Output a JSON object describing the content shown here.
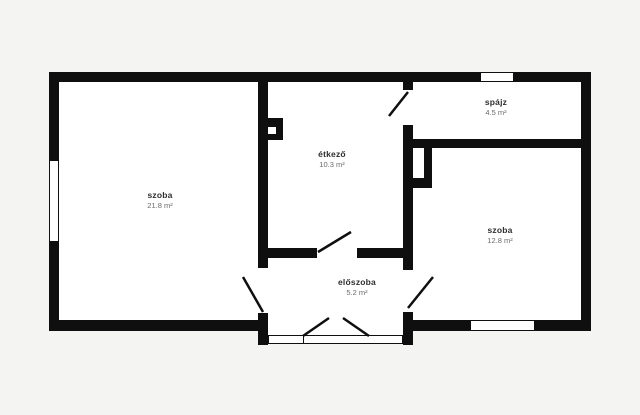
{
  "floor_plan": {
    "colors": {
      "background": "#f4f4f2",
      "wall": "#0f0f0f",
      "room_fill": "#ffffff",
      "label_text": "#2e2e2e",
      "area_text": "#6a6a6a"
    },
    "rooms": [
      {
        "name": "szoba",
        "area": "21.8 m²"
      },
      {
        "name": "étkező",
        "area": "10.3 m²"
      },
      {
        "name": "spájz",
        "area": "4.5 m²"
      },
      {
        "name": "szoba",
        "area": "12.8 m²"
      },
      {
        "name": "előszoba",
        "area": "5.2 m²"
      }
    ]
  }
}
